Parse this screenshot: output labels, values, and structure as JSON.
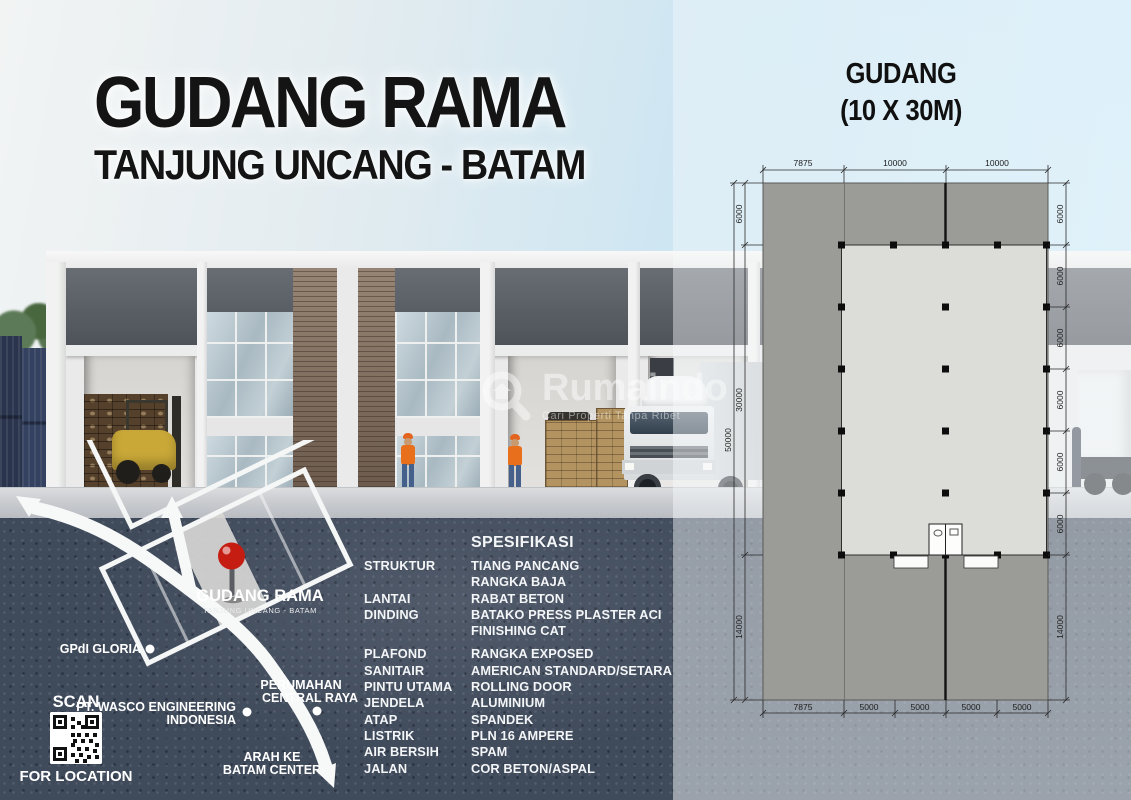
{
  "header": {
    "title": "GUDANG RAMA",
    "subtitle": "TANJUNG UNCANG - BATAM"
  },
  "plan_title": {
    "line1": "GUDANG",
    "line2": "(10 X 30M)"
  },
  "watermark": {
    "brand": "Rumaindo",
    "tagline": "Cari Properti Tanpa Ribet"
  },
  "map": {
    "site": {
      "name": "GUDANG RAMA",
      "subname": "TANJUNG UNCANG - BATAM"
    },
    "landmarks": [
      {
        "line1": "GPdI GLORIA",
        "line2": ""
      },
      {
        "line1": "PT. WASCO ENGINEERING",
        "line2": "INDONESIA"
      },
      {
        "line1": "PERUMAHAN",
        "line2": "CENTRAL RAYA"
      }
    ],
    "direction": {
      "line1": "ARAH KE",
      "line2": "BATAM CENTER"
    },
    "qr": {
      "label_top": "SCAN",
      "label_bottom": "FOR LOCATION"
    }
  },
  "spec": {
    "heading": "SPESIFIKASI",
    "rows": [
      {
        "label": "STRUKTUR",
        "value": "TIANG PANCANG"
      },
      {
        "label": "",
        "value": "RANGKA BAJA"
      },
      {
        "label": "LANTAI",
        "value": "RABAT BETON"
      },
      {
        "label": "DINDING",
        "value": "BATAKO PRESS PLASTER ACI"
      },
      {
        "label": "",
        "value": "FINISHING CAT"
      },
      {
        "label": "PLAFOND",
        "value": "RANGKA EXPOSED"
      },
      {
        "label": "SANITAIR",
        "value": "AMERICAN STANDARD/SETARA"
      },
      {
        "label": "PINTU UTAMA",
        "value": "ROLLING DOOR"
      },
      {
        "label": "JENDELA",
        "value": "ALUMINIUM"
      },
      {
        "label": "ATAP",
        "value": "SPANDEK"
      },
      {
        "label": "LISTRIK",
        "value": "PLN 16 AMPERE"
      },
      {
        "label": "AIR BERSIH",
        "value": "SPAM"
      },
      {
        "label": "JALAN",
        "value": "COR BETON/ASPAL"
      }
    ]
  },
  "plan": {
    "top_dims": [
      "7875",
      "10000",
      "10000"
    ],
    "bottom_dims": [
      "7875",
      "5000",
      "5000",
      "5000",
      "5000"
    ],
    "left_dims": [
      "6000",
      "30000",
      "14000"
    ],
    "left_total": "50000",
    "right_dims": [
      "6000",
      "6000",
      "6000",
      "6000",
      "6000",
      "6000",
      "14000"
    ]
  },
  "colors": {
    "pin_red": "#d42b2b",
    "navy_ground": "#3f4a5b",
    "plan_gray": "#9b9b98",
    "sky_blue": "#cfebf8"
  }
}
